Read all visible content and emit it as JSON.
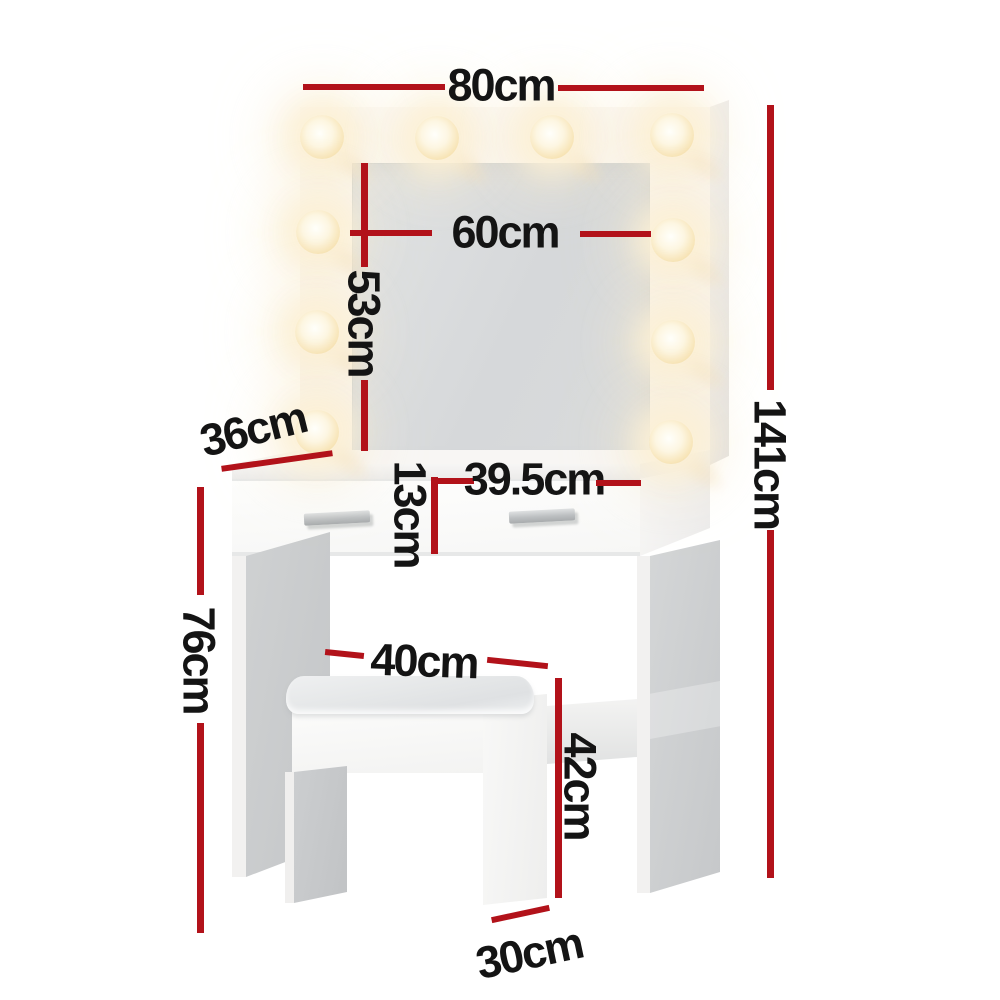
{
  "diagram": {
    "product": "Dressing table with LED mirror and storage stool",
    "style": {
      "accent_color": "#b2121a",
      "text_color": "#141414",
      "background": "#ffffff"
    },
    "led_bulb_count": 10,
    "dimensions": [
      {
        "id": "total_width",
        "label": "80cm"
      },
      {
        "id": "mirror_width",
        "label": "60cm"
      },
      {
        "id": "mirror_height",
        "label": "53cm"
      },
      {
        "id": "table_depth",
        "label": "36cm"
      },
      {
        "id": "total_height",
        "label": "141cm"
      },
      {
        "id": "drawer_height",
        "label": "13cm"
      },
      {
        "id": "drawer_width",
        "label": "39.5cm"
      },
      {
        "id": "table_height",
        "label": "76cm"
      },
      {
        "id": "stool_width",
        "label": "40cm"
      },
      {
        "id": "stool_height",
        "label": "42cm"
      },
      {
        "id": "stool_depth",
        "label": "30cm"
      }
    ]
  }
}
